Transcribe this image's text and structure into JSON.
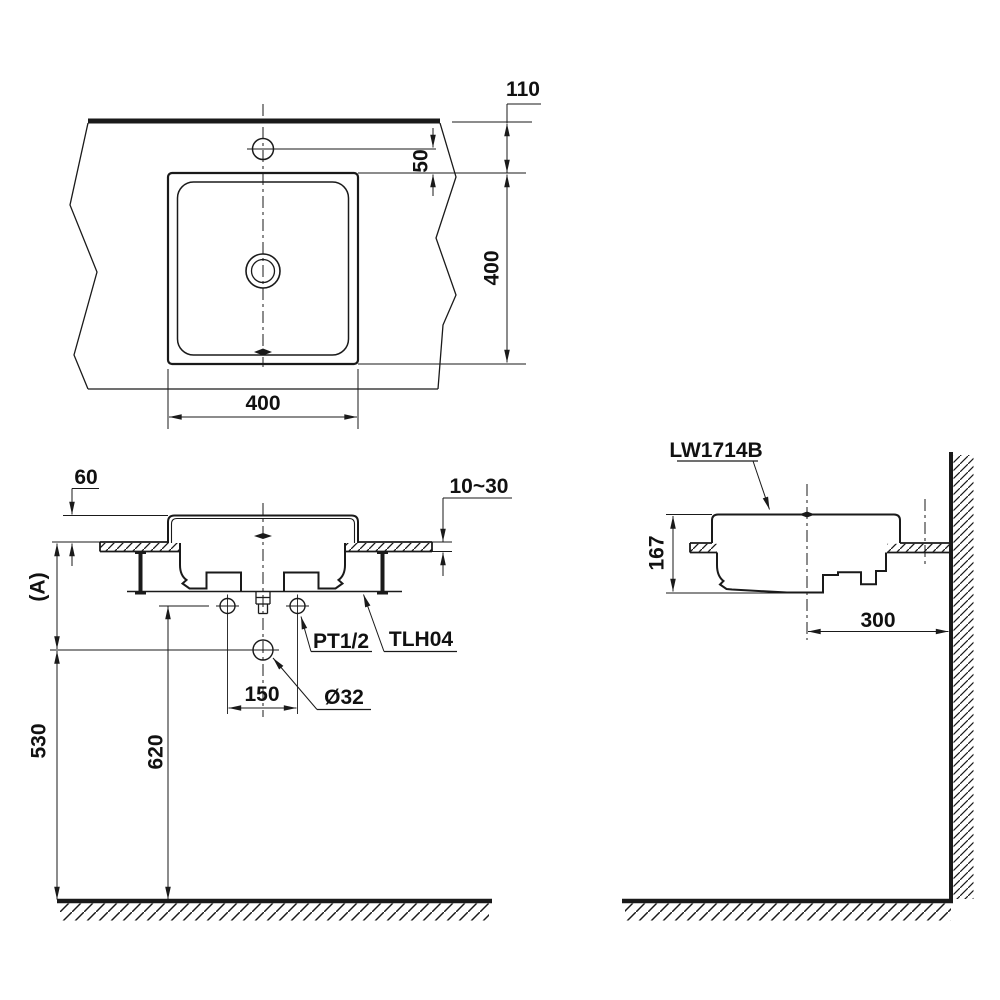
{
  "drawing": {
    "product_code": "LW1714B",
    "top_view": {
      "dim_110": "110",
      "dim_50": "50",
      "dim_400_vertical": "400",
      "dim_400_horizontal": "400"
    },
    "front_view": {
      "dim_60": "60",
      "dim_10_30": "10~30",
      "dim_a": "(A)",
      "dim_150": "150",
      "dim_o32": "Ø32",
      "dim_620": "620",
      "dim_530": "530",
      "label_pt": "PT1/2",
      "label_tlh": "TLH04"
    },
    "side_view": {
      "label_model": "LW1714B",
      "dim_167": "167",
      "dim_300": "300"
    },
    "colors": {
      "line": "#1a1a1a",
      "background": "#ffffff"
    }
  }
}
